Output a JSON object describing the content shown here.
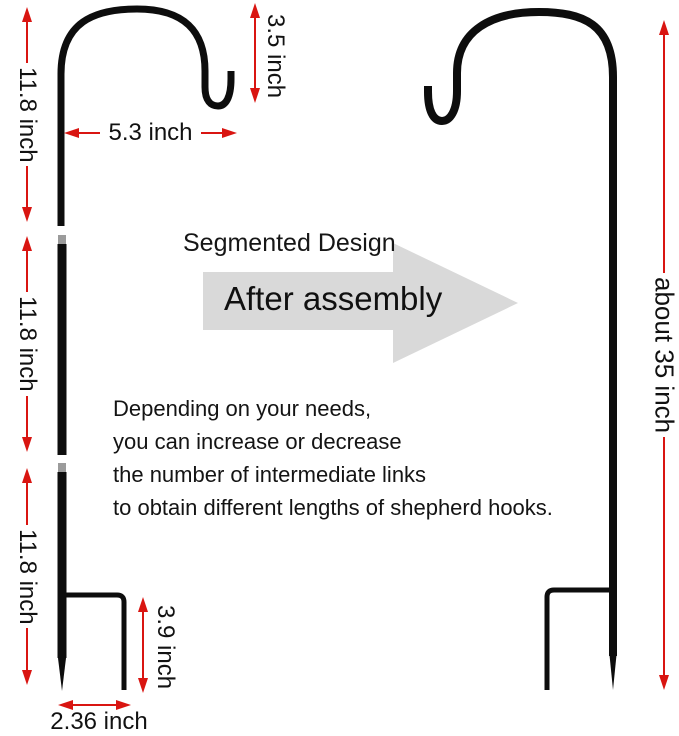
{
  "colors": {
    "dimension_red": "#d91511",
    "arrow_gray": "#d9d9d9",
    "hook_black": "#0d0d0d"
  },
  "dimensions": {
    "segment1_length": "11.8 inch",
    "segment2_length": "11.8 inch",
    "segment3_length": "11.8 inch",
    "hook_height": "3.5 inch",
    "hook_width": "5.3 inch",
    "ground_stake_height": "3.9 inch",
    "ground_stake_width": "2.36 inch",
    "assembled_height": "about 35 inch"
  },
  "labels": {
    "design_title": "Segmented Design",
    "arrow_caption": "After assembly",
    "description_lines": [
      "Depending on your needs,",
      "you can increase or decrease",
      "the number of intermediate links",
      "to obtain different lengths of shepherd hooks."
    ]
  }
}
